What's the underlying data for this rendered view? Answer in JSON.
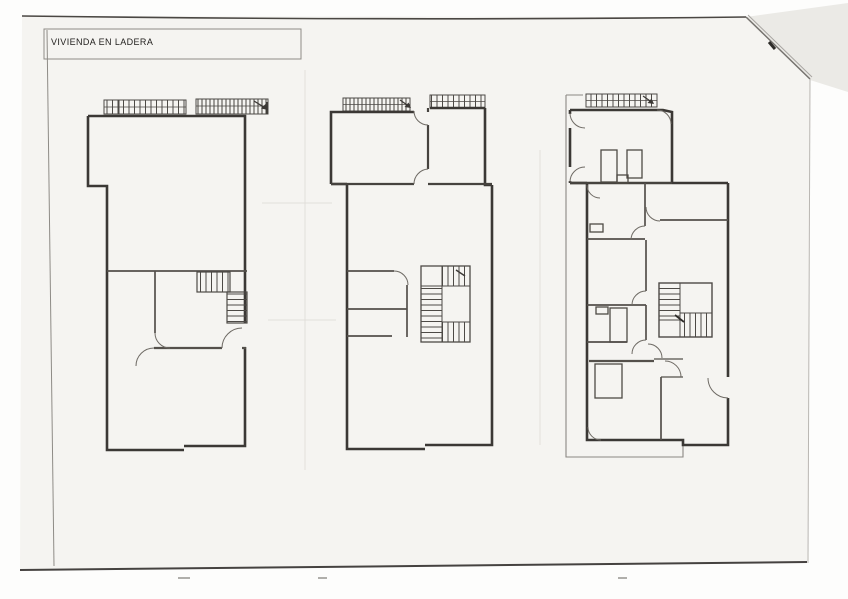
{
  "page": {
    "title": "VIVIENDA EN LADERA"
  },
  "scan": {
    "paper_color": "#f5f4f1",
    "background_color": "#fdfdfc",
    "ink_color": "#3b3835",
    "fold_shade_color": "#ebeae6",
    "edge_line_color": "#454240"
  },
  "plans": [
    {
      "name": "floor-plan-left"
    },
    {
      "name": "floor-plan-middle"
    },
    {
      "name": "floor-plan-right"
    }
  ]
}
